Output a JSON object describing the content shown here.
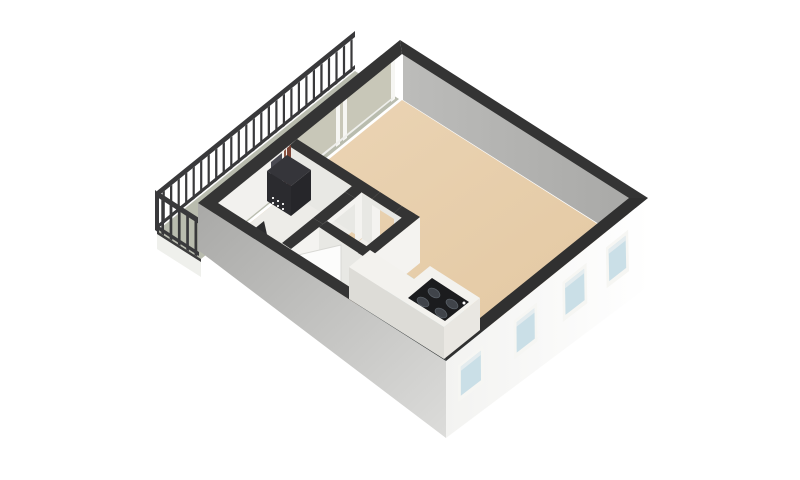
{
  "view": {
    "type": "3d-floorplan",
    "description": "Isometric 3D floor plan of a studio apartment with balcony, open living room, kitchen corner, hallway, storage nook and technical closet",
    "background": "#ffffff"
  },
  "colors": {
    "floor_main": "#e8cfae",
    "floor_kitchen": "#bedade",
    "floor_service": "#edece8",
    "floor_nook": "#f0efeb",
    "floor_under_windows": "#edefed",
    "balcony_slab": "#b9bcae",
    "balcony_slab_edge": "#eff0ec",
    "glass_balcony_door": "#c8c7b8",
    "wall_top_band": "#343434",
    "wall_interior_far": "#b3b2b0",
    "wall_interior_white": "#f2f1ee",
    "wall_exterior_front": "#fbfbfa",
    "wall_exterior_side": "#c0c0be",
    "window_frame": "#f6f6f3",
    "window_glass": "#cadfe7",
    "railing": "#39393b",
    "boiler_body": "#2b2b2f",
    "boiler_dots": "#e8e8e8",
    "pipe_copper": "#7c4435",
    "pipe_copper_light": "#8d5644",
    "conduit": "#4a4a52",
    "counter_top": "#f3f2ee",
    "counter_front": "#e9e7e2",
    "counter_side": "#dddcd7",
    "cooktop": "#1b1c1e",
    "burner": "#40444a",
    "door_panel": "#fcfcfb",
    "object_dark": "#2c2c2e"
  },
  "rooms": [
    {
      "name": "living-room",
      "floor": "beige"
    },
    {
      "name": "kitchen-corner",
      "floor": "light-blue"
    },
    {
      "name": "hallway",
      "floor": "beige"
    },
    {
      "name": "technical-closet",
      "floor": "white"
    },
    {
      "name": "storage-nook",
      "floor": "white"
    },
    {
      "name": "balcony",
      "floor": "gray-green"
    }
  ],
  "objects": {
    "front_windows": 4,
    "sliding_door_panels": 2,
    "cooktop_burners": 4,
    "boiler_pipes": 2,
    "entry_door_state": "open",
    "railing_sides": 2
  }
}
